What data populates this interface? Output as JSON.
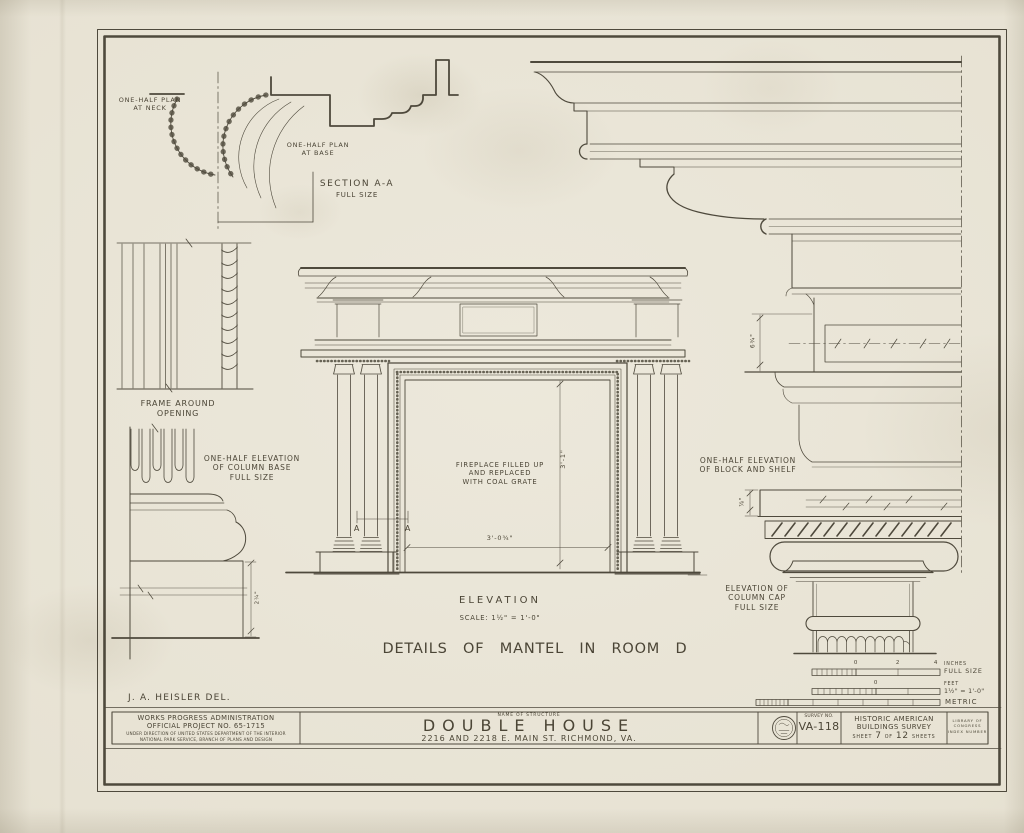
{
  "sheet": {
    "title": "DETAILS OF MANTEL IN ROOM D",
    "delineator": "J. A. HEISLER    DEL.",
    "ink": "#3e392c",
    "paper": "#eae6d9"
  },
  "annotations": {
    "plan_neck": "ONE-HALF PLAN\nAT NECK",
    "plan_base": "ONE-HALF PLAN\nAT  BASE",
    "section": "SECTION  A-A",
    "section_sub": "FULL SIZE",
    "frame": "FRAME  AROUND\nOPENING",
    "col_base": "ONE-HALF  ELEVATION\nOF  COLUMN  BASE\nFULL  SIZE",
    "fireplace": "FIREPLACE  FILLED  UP\nAND  REPLACED\nWITH  COAL  GRATE",
    "block_shelf": "ONE-HALF  ELEVATION\nOF  BLOCK  AND  SHELF",
    "col_cap": "ELEVATION  OF\nCOLUMN  CAP\nFULL SIZE",
    "elevation": "ELEVATION",
    "elevation_scale": "SCALE:   1½\" =  1'-0\""
  },
  "dimensions": {
    "opening_width": "3'-0¾\"",
    "opening_height": "3'-1\"",
    "frieze_height": "6¾\"",
    "shelf_thickness": "⅞\"",
    "plinth_height": "2¼\"",
    "marker": "A"
  },
  "scale_bars": {
    "bar1_ticks": [
      "0",
      "2",
      "4"
    ],
    "bar1_unit": "INCHES",
    "bar1_label": "FULL SIZE",
    "bar2_tick": "0",
    "bar2_unit": "FEET",
    "bar2_label": "1½\" = 1'-0\"",
    "bar3_label": "METRIC"
  },
  "title_block": {
    "wpa1": "WORKS  PROGRESS  ADMINISTRATION",
    "wpa2": "OFFICIAL  PROJECT  NO.  65-1715",
    "wpa3": "UNDER DIRECTION OF UNITED STATES DEPARTMENT OF THE INTERIOR",
    "wpa4": "NATIONAL PARK SERVICE, BRANCH OF PLANS AND DESIGN",
    "name_label": "NAME OF STRUCTURE",
    "structure": "DOUBLE  HOUSE",
    "address": "2216 AND 2218 E. MAIN ST.  RICHMOND, VA.",
    "survey_label": "SURVEY NO.",
    "survey_no": "VA-118",
    "habs1": "HISTORIC AMERICAN",
    "habs2": "BUILDINGS SURVEY",
    "sheet_prefix": "SHEET",
    "sheet_no": "7",
    "sheet_of": "OF",
    "sheet_total": "12",
    "sheet_suffix": "SHEETS",
    "loc": "LIBRARY OF CONGRESS\nINDEX NUMBER"
  }
}
